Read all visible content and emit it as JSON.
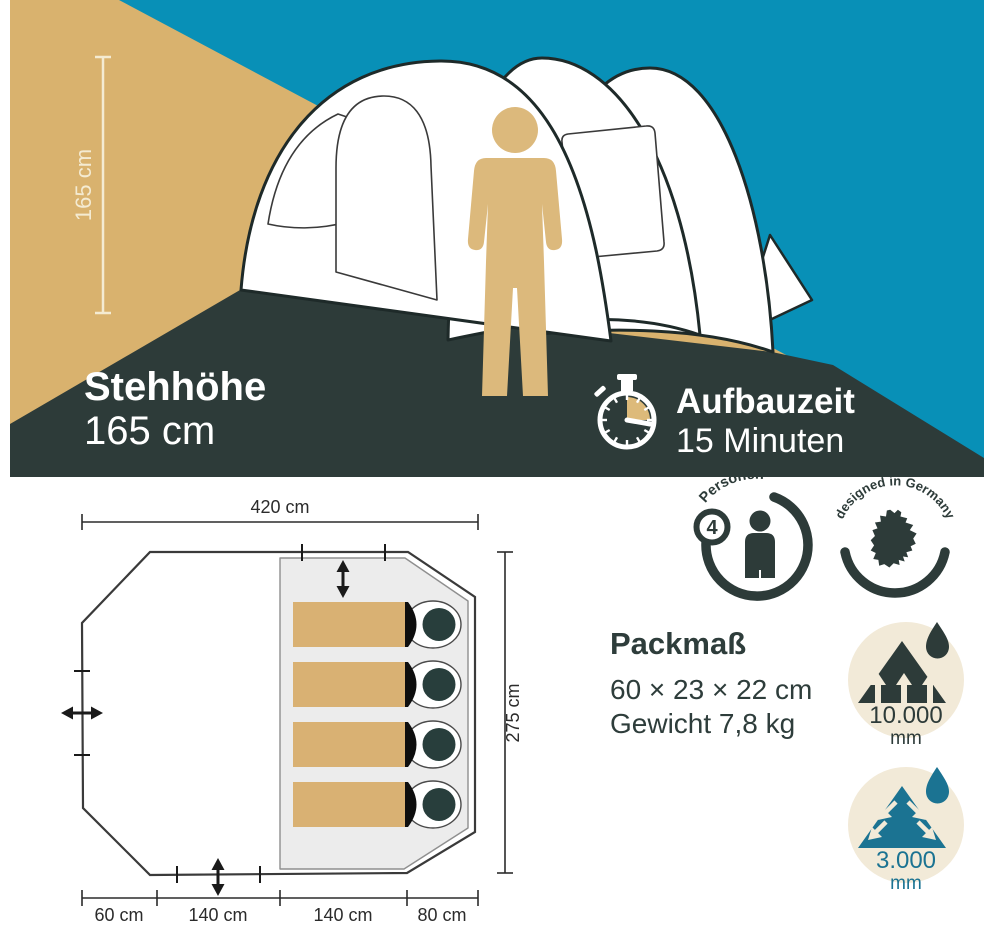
{
  "colors": {
    "teal": "#0890b7",
    "tan": "#d9b26e",
    "dark": "#2d3b39",
    "cream": "#f4ebd2",
    "badge_cream": "#f2ead8",
    "badge_teal": "#1b7392",
    "mat_tan": "#d9b173",
    "person_tan": "#dcb97c"
  },
  "top_section": {
    "height_measure": "165 cm",
    "standing_height_label": "Stehhöhe",
    "standing_height_value": "165 cm",
    "setup_time_label": "Aufbauzeit",
    "setup_time_value": "15 Minuten"
  },
  "floor_plan": {
    "total_width": "420 cm",
    "total_depth": "275 cm",
    "bottom_segments": [
      "60 cm",
      "140 cm",
      "140 cm",
      "80 cm"
    ]
  },
  "badges": {
    "persons_label": "Personen",
    "persons_count": "4",
    "designed_label": "designed in Germany",
    "hydrostatic_head_tent": {
      "value": "10.000",
      "unit": "mm"
    },
    "hydrostatic_head_floor": {
      "value": "3.000",
      "unit": "mm"
    }
  },
  "pack_size": {
    "title": "Packmaß",
    "dimensions": "60 × 23 × 22 cm",
    "weight": "Gewicht 7,8 kg"
  }
}
